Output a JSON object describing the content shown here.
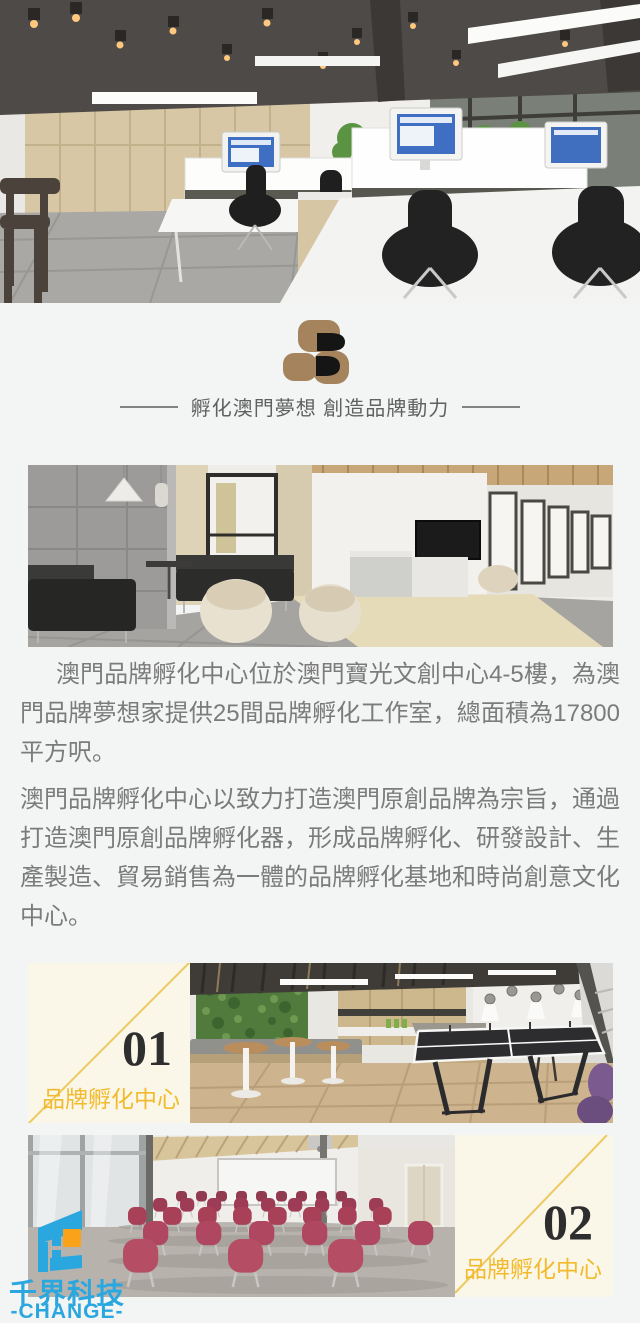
{
  "brand": {
    "tagline": "孵化澳門夢想 創造品牌動力"
  },
  "intro": {
    "paragraphs": [
      "澳門品牌孵化中心位於澳門寶光文創中心4-5樓，為澳門品牌夢想家提供25間品牌孵化工作室，總面積為17800平方呎。",
      "澳門品牌孵化中心以致力打造澳門原創品牌為宗旨，通過打造澳門原創品牌孵化器，形成品牌孵化、研發設計、生產製造、貿易銷售為一體的品牌孵化基地和時尚創意文化中心。"
    ]
  },
  "gallery": [
    {
      "number": "01",
      "label": "品牌孵化中心"
    },
    {
      "number": "02",
      "label": "品牌孵化中心"
    }
  ],
  "watermark": {
    "name_cn": "千界科技",
    "name_en": "-CHANGE-"
  },
  "colors": {
    "accent_yellow": "#f2bb2d",
    "panel_cream": "#faf6e8",
    "logo_brown": "#a5835c",
    "watermark_blue": "#2aa7df",
    "watermark_orange": "#f9a21a"
  }
}
